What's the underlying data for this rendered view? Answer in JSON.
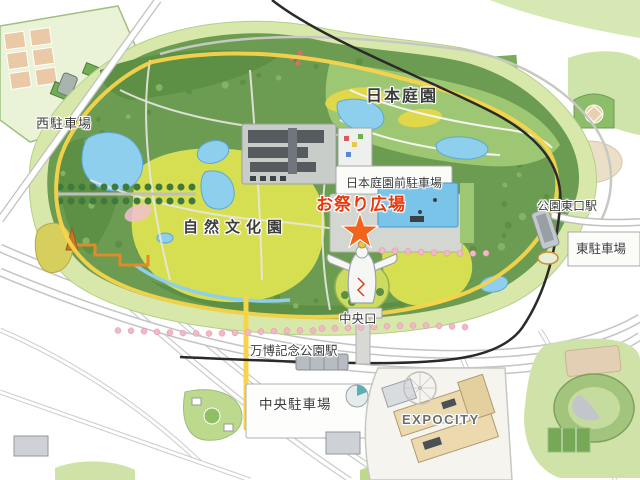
{
  "labels": {
    "nishi_parking": "西駐車場",
    "nihon_teien": "日本庭園",
    "teien_mae_parking": "日本庭園前駐車場",
    "omatsuri_hiroba": "お祭り広場",
    "shizen_bunkaen": "自然文化園",
    "koen_higashiguchi_eki": "公園東口駅",
    "higashi_parking": "東駐車場",
    "chuoguchi": "中央口",
    "banpaku_kinen_koen_eki": "万博記念公園駅",
    "chuo_parking": "中央駐車場",
    "expocity": "EXPOCITY"
  },
  "marker": {
    "shape": "star",
    "marks": "お祭り広場"
  },
  "colors": {
    "omatsuri_red": "#e8380d",
    "star_orange": "#f2641e",
    "label_dark": "#3c3c3c",
    "expocity_gray": "#6e6e6e",
    "park_green": "#d8e8ab",
    "forest_green": "#6b9c52",
    "forest_dark": "#5d8f45",
    "forest_light": "#86b262",
    "lawn_yellow": "#d6de51",
    "garden_green": "#9ec773",
    "pond_blue": "#8ecfed",
    "path_yellow": "#f8d44b",
    "rail_black": "#2a2a2a",
    "cherry_pink": "#f2b8c6",
    "building_beige": "#ecd9ae",
    "building_gray": "#565b60"
  }
}
